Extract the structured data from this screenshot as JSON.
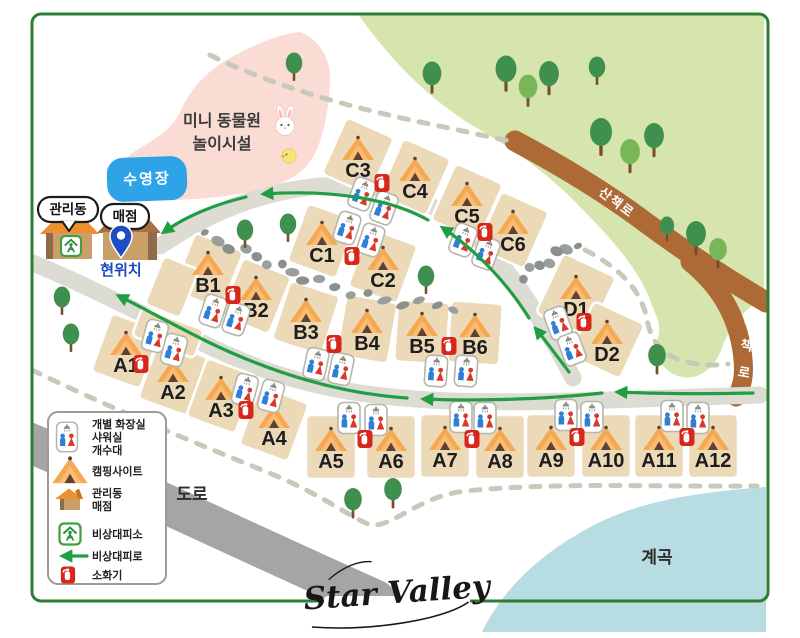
{
  "app": {
    "logo": "Star Valley"
  },
  "labels": {
    "zoo_line1": "미니 동물원",
    "zoo_line2": "놀이시설",
    "pool": "수영장",
    "admin_office": "관리동",
    "store": "매점",
    "current_location": "현위치",
    "trail_diagonal": "산책로",
    "trail_vertical": "산책로",
    "road": "도로",
    "valley": "계곡"
  },
  "legend": {
    "rows": [
      {
        "icon": "restroom-icon",
        "line1": "개별 화장실",
        "line2": "샤워실",
        "line3": "개수대"
      },
      {
        "icon": "tent-icon",
        "line1": "캠핑사이트"
      },
      {
        "icon": "house-icon",
        "line1": "관리동",
        "line2": "매점"
      },
      {
        "icon": "shelter-icon",
        "line1": "비상대피소"
      },
      {
        "icon": "evac-arrow-icon",
        "line1": "비상대피로"
      },
      {
        "icon": "extinguisher-icon",
        "line1": "소화기"
      }
    ]
  },
  "sites": [
    {
      "id": "A1",
      "x": 126,
      "y": 351,
      "rot": 20
    },
    {
      "id": "A2",
      "x": 173,
      "y": 378,
      "rot": 20
    },
    {
      "id": "A3",
      "x": 221,
      "y": 396,
      "rot": 20
    },
    {
      "id": "A4",
      "x": 274,
      "y": 424,
      "rot": 20
    },
    {
      "id": "A5",
      "x": 331,
      "y": 447,
      "rot": 0,
      "w": 50,
      "h": 64
    },
    {
      "id": "A6",
      "x": 391,
      "y": 447,
      "rot": 0,
      "w": 50,
      "h": 64
    },
    {
      "id": "A7",
      "x": 445,
      "y": 446,
      "rot": 0,
      "w": 50,
      "h": 64
    },
    {
      "id": "A8",
      "x": 500,
      "y": 447,
      "rot": 0,
      "w": 50,
      "h": 64
    },
    {
      "id": "A9",
      "x": 551,
      "y": 446,
      "rot": 0,
      "w": 50,
      "h": 64
    },
    {
      "id": "A10",
      "x": 606,
      "y": 446,
      "rot": 0,
      "w": 50,
      "h": 64
    },
    {
      "id": "A11",
      "x": 659,
      "y": 446,
      "rot": 0,
      "w": 50,
      "h": 64
    },
    {
      "id": "A12",
      "x": 713,
      "y": 446,
      "rot": 0,
      "w": 50,
      "h": 64
    },
    {
      "id": "B1",
      "x": 208,
      "y": 271,
      "rot": 22
    },
    {
      "id": "B2",
      "x": 256,
      "y": 296,
      "rot": 22
    },
    {
      "id": "B3",
      "x": 306,
      "y": 318,
      "rot": 18
    },
    {
      "id": "B4",
      "x": 367,
      "y": 329,
      "rot": 10
    },
    {
      "id": "B5",
      "x": 422,
      "y": 332,
      "rot": 4
    },
    {
      "id": "B6",
      "x": 475,
      "y": 333,
      "rot": 4
    },
    {
      "id": "C1",
      "x": 322,
      "y": 241,
      "rot": 20
    },
    {
      "id": "C2",
      "x": 383,
      "y": 266,
      "rot": 20
    },
    {
      "id": "C3",
      "x": 358,
      "y": 156,
      "rot": 24
    },
    {
      "id": "C4",
      "x": 415,
      "y": 177,
      "rot": 24
    },
    {
      "id": "C5",
      "x": 467,
      "y": 202,
      "rot": 24
    },
    {
      "id": "C6",
      "x": 513,
      "y": 230,
      "rot": 24
    },
    {
      "id": "D1",
      "x": 576,
      "y": 295,
      "rot": 25,
      "w": 58,
      "h": 66
    },
    {
      "id": "D2",
      "x": 607,
      "y": 340,
      "rot": 25,
      "w": 56,
      "h": 60
    },
    {
      "id": "",
      "x": 172,
      "y": 287,
      "rot": 22,
      "w": 38,
      "h": 52,
      "blank": true
    },
    {
      "id": "",
      "x": 168,
      "y": 333,
      "rot": 20,
      "w": 66,
      "h": 30,
      "blank": true
    }
  ],
  "markers": {
    "restrooms": [
      {
        "x": 362,
        "y": 194,
        "rot": 20
      },
      {
        "x": 384,
        "y": 208,
        "rot": 20
      },
      {
        "x": 347,
        "y": 228,
        "rot": 18
      },
      {
        "x": 371,
        "y": 240,
        "rot": 18
      },
      {
        "x": 463,
        "y": 240,
        "rot": 20
      },
      {
        "x": 486,
        "y": 253,
        "rot": 20
      },
      {
        "x": 213,
        "y": 311,
        "rot": 18
      },
      {
        "x": 236,
        "y": 319,
        "rot": 18
      },
      {
        "x": 316,
        "y": 364,
        "rot": 12
      },
      {
        "x": 341,
        "y": 369,
        "rot": 12
      },
      {
        "x": 436,
        "y": 371,
        "rot": 4
      },
      {
        "x": 466,
        "y": 371,
        "rot": 4
      },
      {
        "x": 558,
        "y": 323,
        "rot": -20
      },
      {
        "x": 572,
        "y": 349,
        "rot": -20
      },
      {
        "x": 155,
        "y": 336,
        "rot": 15
      },
      {
        "x": 174,
        "y": 350,
        "rot": 15
      },
      {
        "x": 245,
        "y": 390,
        "rot": 15
      },
      {
        "x": 271,
        "y": 396,
        "rot": 15
      },
      {
        "x": 349,
        "y": 418,
        "rot": 0
      },
      {
        "x": 376,
        "y": 420,
        "rot": 0
      },
      {
        "x": 461,
        "y": 417,
        "rot": 0
      },
      {
        "x": 485,
        "y": 418,
        "rot": 0
      },
      {
        "x": 566,
        "y": 415,
        "rot": 0
      },
      {
        "x": 592,
        "y": 417,
        "rot": 0
      },
      {
        "x": 672,
        "y": 416,
        "rot": 0
      },
      {
        "x": 698,
        "y": 418,
        "rot": 0
      }
    ],
    "extinguishers": [
      {
        "x": 382,
        "y": 183
      },
      {
        "x": 352,
        "y": 256
      },
      {
        "x": 485,
        "y": 232
      },
      {
        "x": 233,
        "y": 295
      },
      {
        "x": 334,
        "y": 344
      },
      {
        "x": 449,
        "y": 346
      },
      {
        "x": 584,
        "y": 322
      },
      {
        "x": 141,
        "y": 364
      },
      {
        "x": 246,
        "y": 410
      },
      {
        "x": 365,
        "y": 439
      },
      {
        "x": 472,
        "y": 439
      },
      {
        "x": 577,
        "y": 437
      },
      {
        "x": 687,
        "y": 437
      }
    ],
    "trees": [
      {
        "x": 294,
        "y": 75,
        "s": 0.75,
        "c": "dark"
      },
      {
        "x": 432,
        "y": 87,
        "s": 0.85,
        "c": "dark"
      },
      {
        "x": 506,
        "y": 84,
        "s": 0.95,
        "c": "dark"
      },
      {
        "x": 528,
        "y": 100,
        "s": 0.85,
        "c": "light"
      },
      {
        "x": 549,
        "y": 88,
        "s": 0.9,
        "c": "dark"
      },
      {
        "x": 597,
        "y": 79,
        "s": 0.75,
        "c": "dark"
      },
      {
        "x": 601,
        "y": 148,
        "s": 1.0,
        "c": "dark"
      },
      {
        "x": 630,
        "y": 166,
        "s": 0.9,
        "c": "light"
      },
      {
        "x": 654,
        "y": 150,
        "s": 0.9,
        "c": "dark"
      },
      {
        "x": 667,
        "y": 236,
        "s": 0.65,
        "c": "dark"
      },
      {
        "x": 696,
        "y": 248,
        "s": 0.9,
        "c": "dark"
      },
      {
        "x": 718,
        "y": 262,
        "s": 0.8,
        "c": "light"
      },
      {
        "x": 62,
        "y": 309,
        "s": 0.75,
        "c": "dark"
      },
      {
        "x": 71,
        "y": 346,
        "s": 0.75,
        "c": "dark"
      },
      {
        "x": 245,
        "y": 242,
        "s": 0.75,
        "c": "dark"
      },
      {
        "x": 288,
        "y": 236,
        "s": 0.75,
        "c": "dark"
      },
      {
        "x": 426,
        "y": 288,
        "s": 0.75,
        "c": "dark"
      },
      {
        "x": 657,
        "y": 368,
        "s": 0.8,
        "c": "dark"
      },
      {
        "x": 353,
        "y": 512,
        "s": 0.8,
        "c": "dark"
      },
      {
        "x": 393,
        "y": 502,
        "s": 0.8,
        "c": "dark"
      }
    ],
    "stone_paths": [
      {
        "points": [
          [
            205,
            236
          ],
          [
            260,
            258
          ],
          [
            310,
            280
          ],
          [
            380,
            300
          ],
          [
            455,
            307
          ]
        ],
        "count": 18
      },
      {
        "points": [
          [
            575,
            244
          ],
          [
            522,
            276
          ]
        ],
        "count": 7
      }
    ]
  },
  "colors": {
    "border_green": "#2e7d33",
    "forest_green": "#d5e5ad",
    "trail_brown": "#ad6a36",
    "road_gray": "#dcdcd2",
    "dark_road_gray": "#a5a5a5",
    "parcel_tan": "#ecd9b8",
    "tent_orange": "#f5a850",
    "water_blue": "#b7dce2",
    "pool_blue": "#2fa3e8",
    "evac_green": "#219e43",
    "zoo_pink": "#fbdcd4",
    "pin_blue": "#1d4dc0",
    "extinguisher_red": "#d7271b"
  }
}
